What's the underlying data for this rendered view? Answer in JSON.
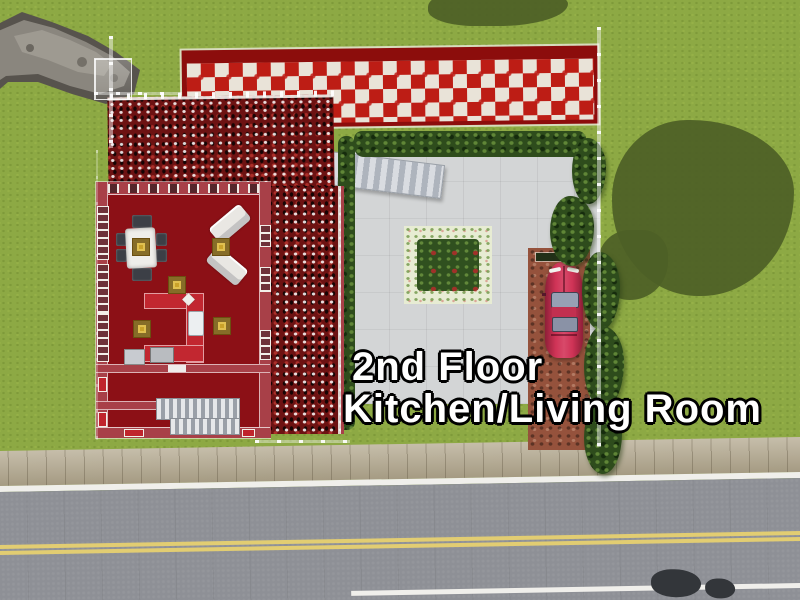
{
  "overlay": {
    "line1": "2nd Floor",
    "line2": "Kitchen/Living Room",
    "text_color": "#ffffff",
    "outline_color": "#000000"
  },
  "colors": {
    "grass": "#8da944",
    "tree-shadow": "#4d6026",
    "hedge": "#2e4c1c",
    "concrete": "#d3d5d6",
    "deck-red": "#bd1d15",
    "deck-white": "#e9e3d8",
    "deck-border": "#8c0d0c",
    "roof-base": "#6d1212",
    "floor-red": "#8c1016",
    "wall-red": "#a84048",
    "counter-red": "#c22730",
    "table-white": "#efeeea",
    "sofa-white": "#e9e7e3",
    "chair-dark": "#3c3f46",
    "lamp-gold": "#c9a22a",
    "garden-border": "#e7ecd3",
    "garden-inner": "#30501f",
    "flower-red": "#a13129",
    "brick": "#95523c",
    "glass": "#97a0b4",
    "sidewalk": "#b3a88e",
    "road": "#8e9096",
    "line-yellow": "#e2cd72",
    "line-white": "#f0efeb",
    "caption": "#ffffff"
  },
  "scene": {
    "view": "top-down lot view, life-simulation game build mode",
    "objects": [
      "rock-outcrop",
      "checkered-upper-deck",
      "mottled-red-roof",
      "red-floor-living-room",
      "dining-table-with-chairs",
      "two-white-loveseats",
      "five-gold-ceiling-lamps",
      "u-shaped-kitchen-counter-with-sink",
      "stove",
      "fridge",
      "interior-staircase",
      "concrete-courtyard",
      "hedges",
      "flower-garden-plot",
      "exterior-staircase",
      "brick-driveway",
      "red-sports-car",
      "trees",
      "lot-boundary-wireframe",
      "sidewalk",
      "asphalt-road-with-double-yellow-line",
      "tree-shadows"
    ]
  }
}
